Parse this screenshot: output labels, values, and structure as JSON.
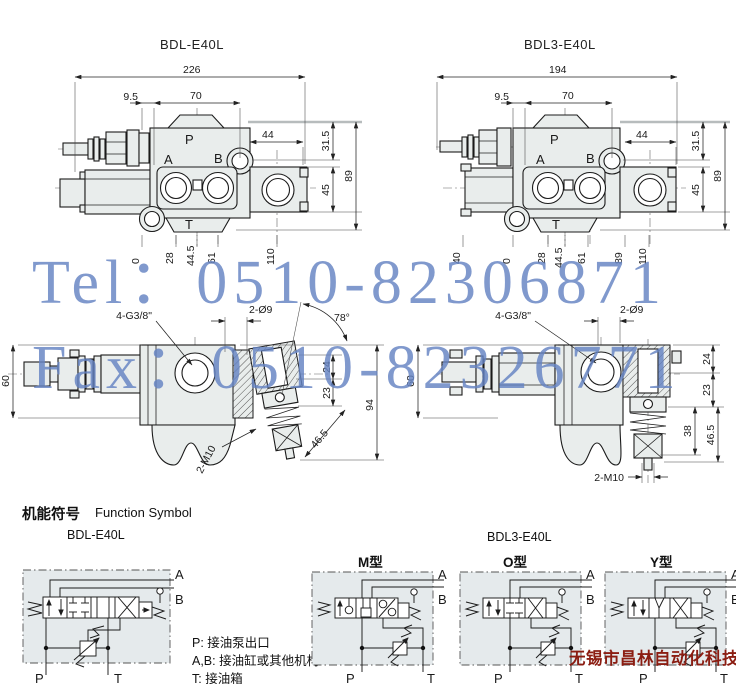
{
  "ports": {
    "a": "A",
    "b": "B",
    "p": "P",
    "t": "T"
  },
  "watermark": {
    "tel": "Tel：0510-82306871",
    "fax": "Fax：0510-82326771",
    "color": "#6583c3"
  },
  "top_left": {
    "title": "BDL-E40L",
    "dims": {
      "total": "226",
      "offset": "9.5",
      "body": "70",
      "outlet": "44",
      "h_top": "31.5",
      "h_total": "89",
      "h_outlet": "45",
      "p0": "0",
      "p28": "28",
      "p445": "44.5",
      "p61": "61",
      "p110": "110"
    }
  },
  "top_right": {
    "title": "BDL3-E40L",
    "dims": {
      "total": "194",
      "offset": "9.5",
      "body": "70",
      "outlet": "44",
      "h_top": "31.5",
      "h_total": "89",
      "h_outlet": "45",
      "p40": "40",
      "p0": "0",
      "p28": "28",
      "p445": "44.5",
      "p61": "61",
      "p89": "89",
      "p110": "110"
    }
  },
  "side_left": {
    "dims": {
      "height": "60",
      "thread": "4-G3/8\"",
      "holes": "2-Ø9",
      "angle": "78°",
      "d24": "24",
      "d23": "23",
      "total": "94",
      "d465": "46.5",
      "bolt": "2-M10"
    }
  },
  "side_right": {
    "dims": {
      "height": "60",
      "thread": "4-G3/8\"",
      "holes": "2-Ø9",
      "d24": "24",
      "d23": "23",
      "d38": "38",
      "d465": "46.5",
      "bolt": "2-M10"
    }
  },
  "functions": {
    "heading_zh": "机能符号",
    "heading_en": "Function Symbol",
    "left_model": "BDL-E40L",
    "right_model": "BDL3-E40L",
    "type_m": "M型",
    "type_o": "O型",
    "type_y": "Y型",
    "legend_p": "P: 接油泵出口",
    "legend_ab": "A,B: 接油缸或其他机构",
    "legend_t": "T: 接油箱",
    "company": "无锡市昌林自动化科技",
    "company_color": "#8b1d12"
  }
}
